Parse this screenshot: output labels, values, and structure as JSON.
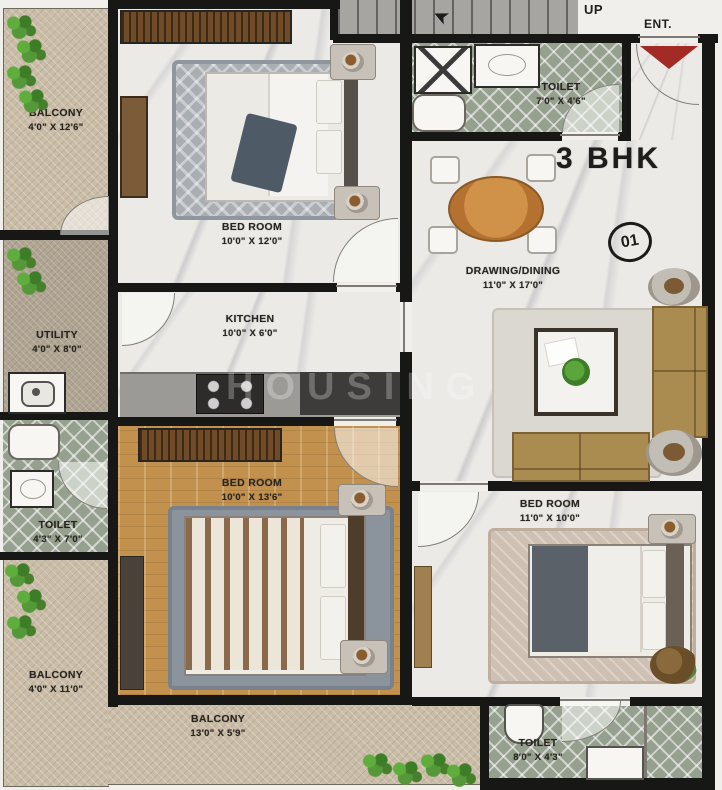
{
  "meta": {
    "title_label": "3 BHK",
    "unit_number": "01",
    "up_label": "UP",
    "entrance_label": "ENT.",
    "watermark": "HOUSING"
  },
  "rooms": {
    "balcony_top_left": {
      "name": "BALCONY",
      "dims": "4'0\" X 12'6\""
    },
    "bedroom_top": {
      "name": "BED ROOM",
      "dims": "10'0\" X 12'0\""
    },
    "toilet_top": {
      "name": "TOILET",
      "dims": "7'0\" X 4'6\""
    },
    "drawing_dining": {
      "name": "DRAWING/DINING",
      "dims": "11'0\" X 17'0\""
    },
    "utility": {
      "name": "UTILITY",
      "dims": "4'0\" X 8'0\""
    },
    "kitchen": {
      "name": "KITCHEN",
      "dims": "10'0\" X 6'0\""
    },
    "toilet_left": {
      "name": "TOILET",
      "dims": "4'3\" X 7'0\""
    },
    "bedroom_middle": {
      "name": "BED ROOM",
      "dims": "10'0\" X 13'6\""
    },
    "bedroom_right": {
      "name": "BED ROOM",
      "dims": "11'0\" X 10'0\""
    },
    "balcony_bottom_left": {
      "name": "BALCONY",
      "dims": "4'0\" X 11'0\""
    },
    "balcony_bottom": {
      "name": "BALCONY",
      "dims": "13'0\" X 5'9\""
    },
    "toilet_bottom": {
      "name": "TOILET",
      "dims": "8'0\" X 4'3\""
    }
  },
  "colors": {
    "wall": "#171716",
    "marble_floor": "#ebeae7",
    "balcony_floor": "#cabda8",
    "wood_floor": "#c2914e",
    "toilet_tile": "#96a08e",
    "sofa": "#aa8b50",
    "dining_table": "#c07f3a",
    "entrance_arrow": "#a22b25",
    "plant_green": "#4c8a2e"
  }
}
